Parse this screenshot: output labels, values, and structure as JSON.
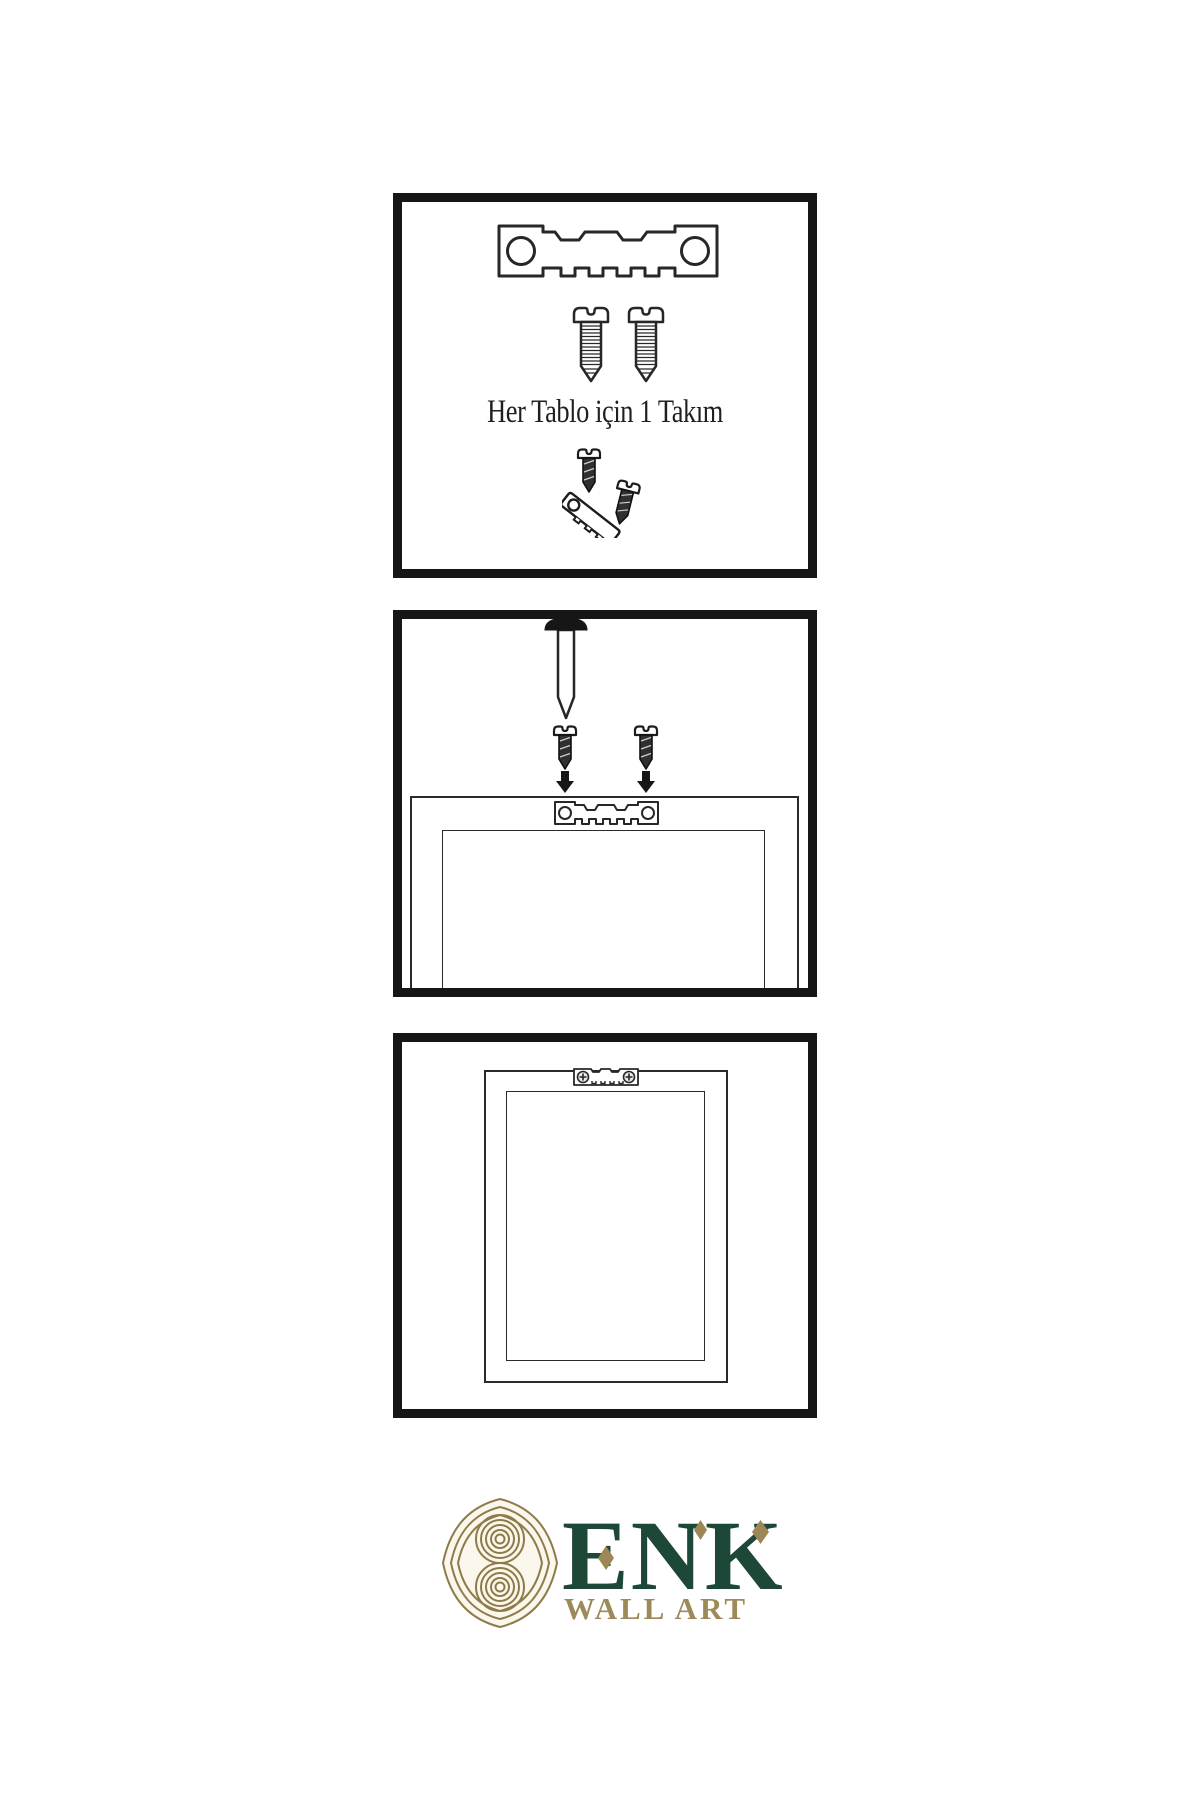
{
  "page": {
    "background": "#ffffff",
    "line_color": "#161616"
  },
  "panels": {
    "kit": {
      "caption": "Her Tablo için 1 Takım",
      "items": [
        "sawtooth-hanger",
        "screw",
        "screw",
        "screw-into-hanger-demo"
      ]
    },
    "mounting": {
      "items": [
        "wall-nail",
        "screw-drop-left",
        "screw-drop-right",
        "down-arrow",
        "down-arrow",
        "frame-back",
        "sawtooth-hanger-small"
      ]
    },
    "hung": {
      "items": [
        "frame-back",
        "sawtooth-hanger-installed"
      ]
    }
  },
  "logo": {
    "name": "ENK",
    "subtitle": "WALL ART",
    "colors": {
      "text_green": "#1d4737",
      "gold": "#9d8756",
      "knot_gold": "#8d7b4a"
    }
  }
}
